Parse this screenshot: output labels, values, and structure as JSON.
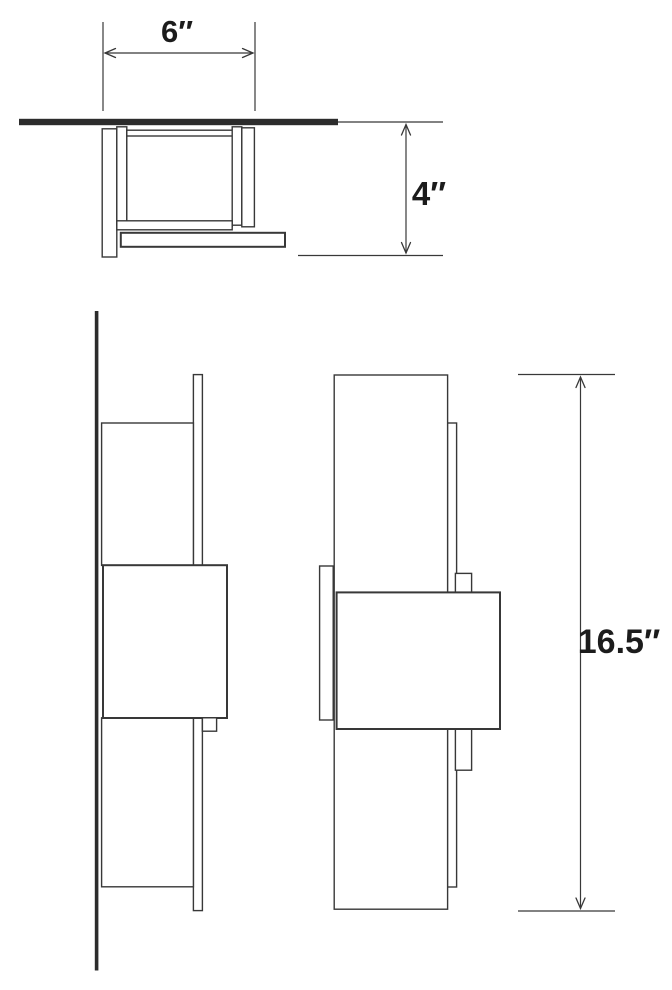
{
  "colors": {
    "background": "#ffffff",
    "line": "#383838",
    "wall": "#2c2c2c",
    "text": "#1c1c1c"
  },
  "diagram": {
    "dimensions": {
      "width": {
        "label": "6″",
        "inches": 6
      },
      "depth": {
        "label": "4″",
        "inches": 4
      },
      "height": {
        "label": "16.5″",
        "inches": 16.5
      }
    }
  }
}
